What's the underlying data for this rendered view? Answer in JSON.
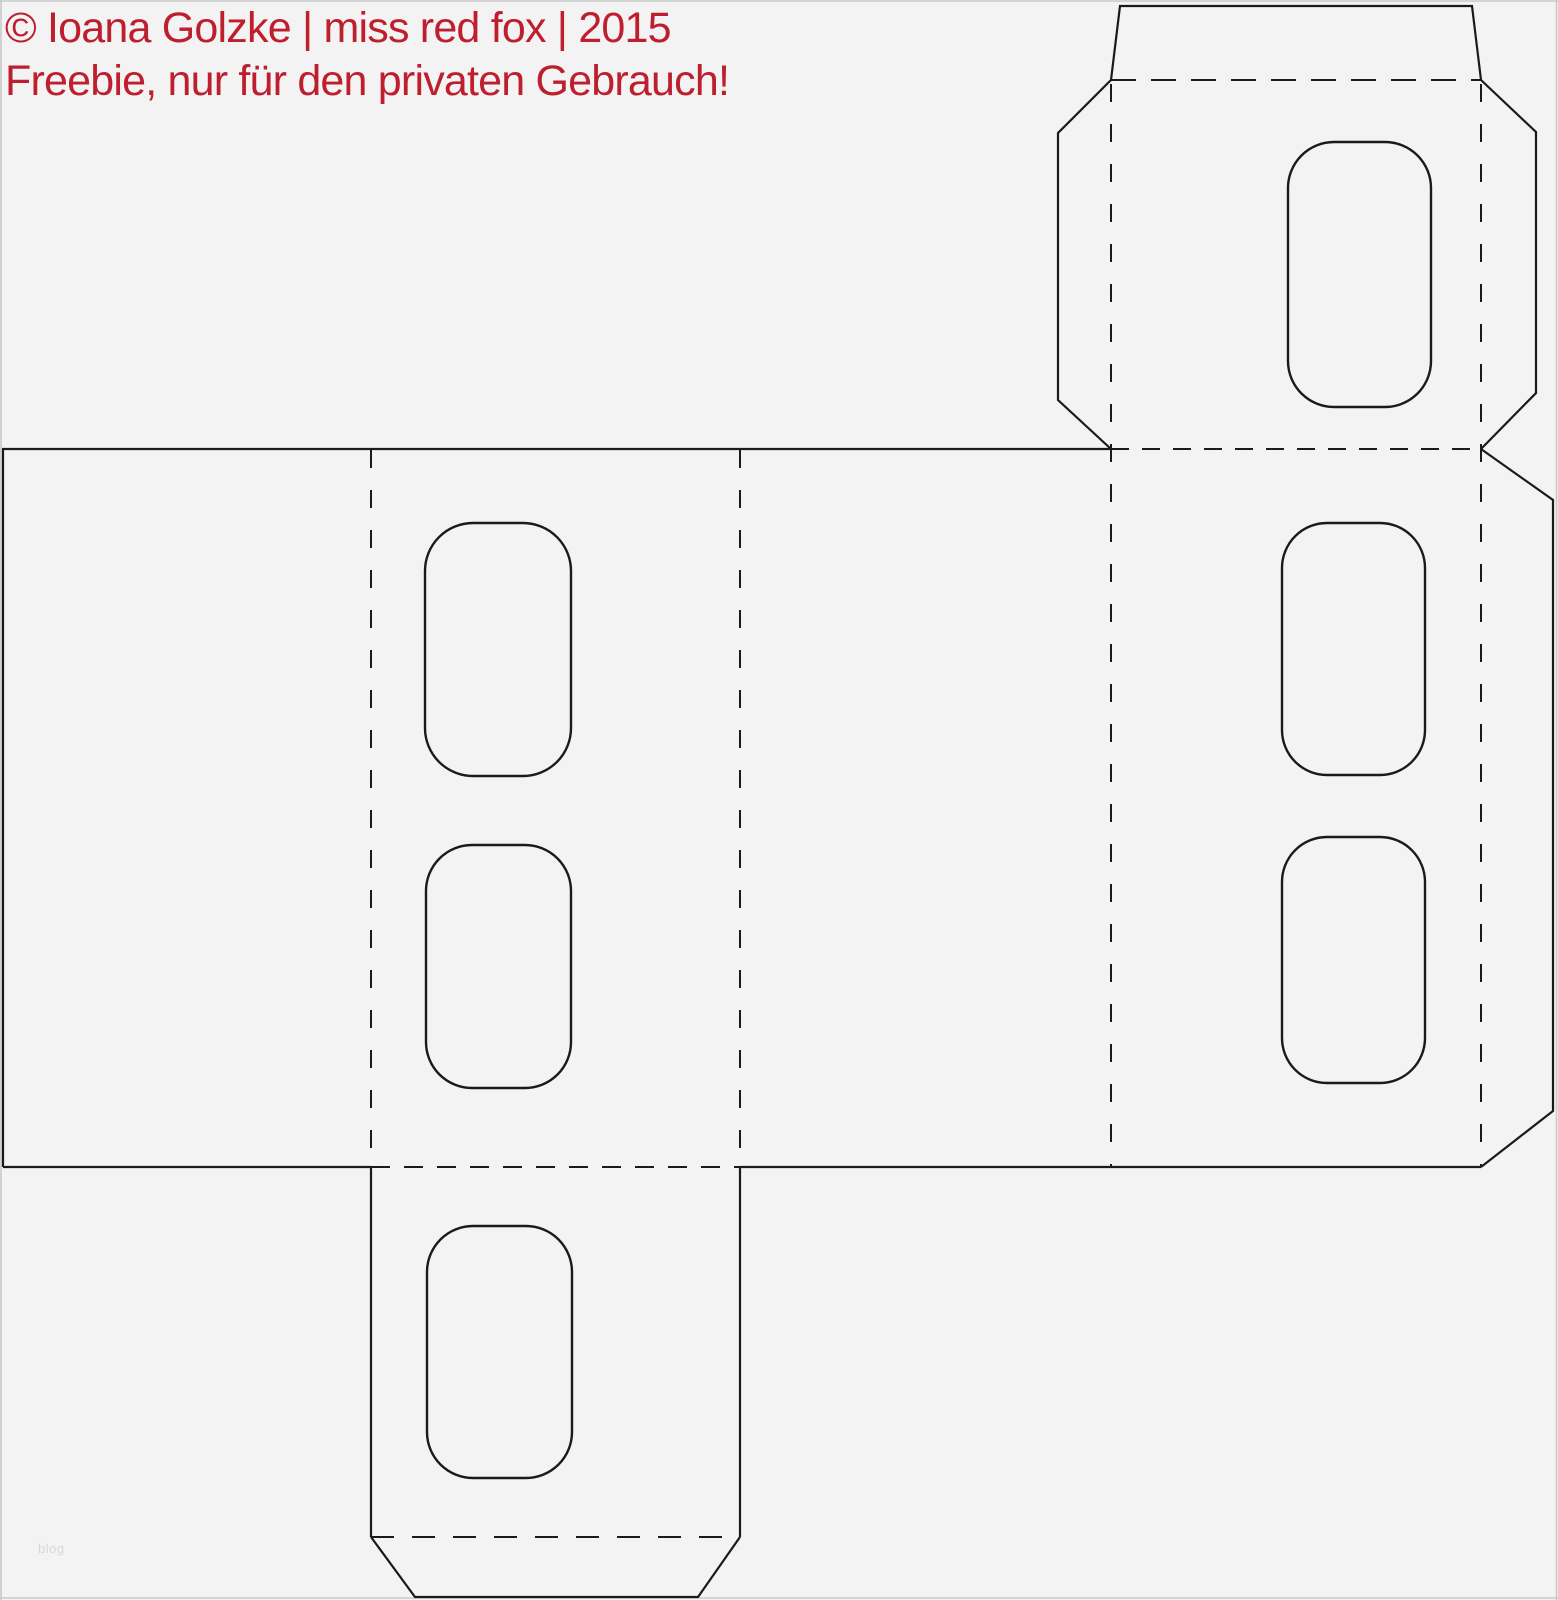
{
  "page": {
    "kind": "printable die-cut box template scan",
    "background": "#f3f3f3",
    "width": 1558,
    "height": 1600
  },
  "colors": {
    "bg": "#f3f3f3",
    "cut": "#1a1a1a",
    "fold": "#1a1a1a",
    "red": "#be1e2d",
    "border": "#c9c9c9",
    "watermark": "#d8d8d8"
  },
  "copyright": {
    "line1": "© Ioana Golzke | miss red fox | 2015",
    "line2": "Freebie, nur für den privaten Gebrauch!"
  },
  "watermark": {
    "text": "blog"
  }
}
